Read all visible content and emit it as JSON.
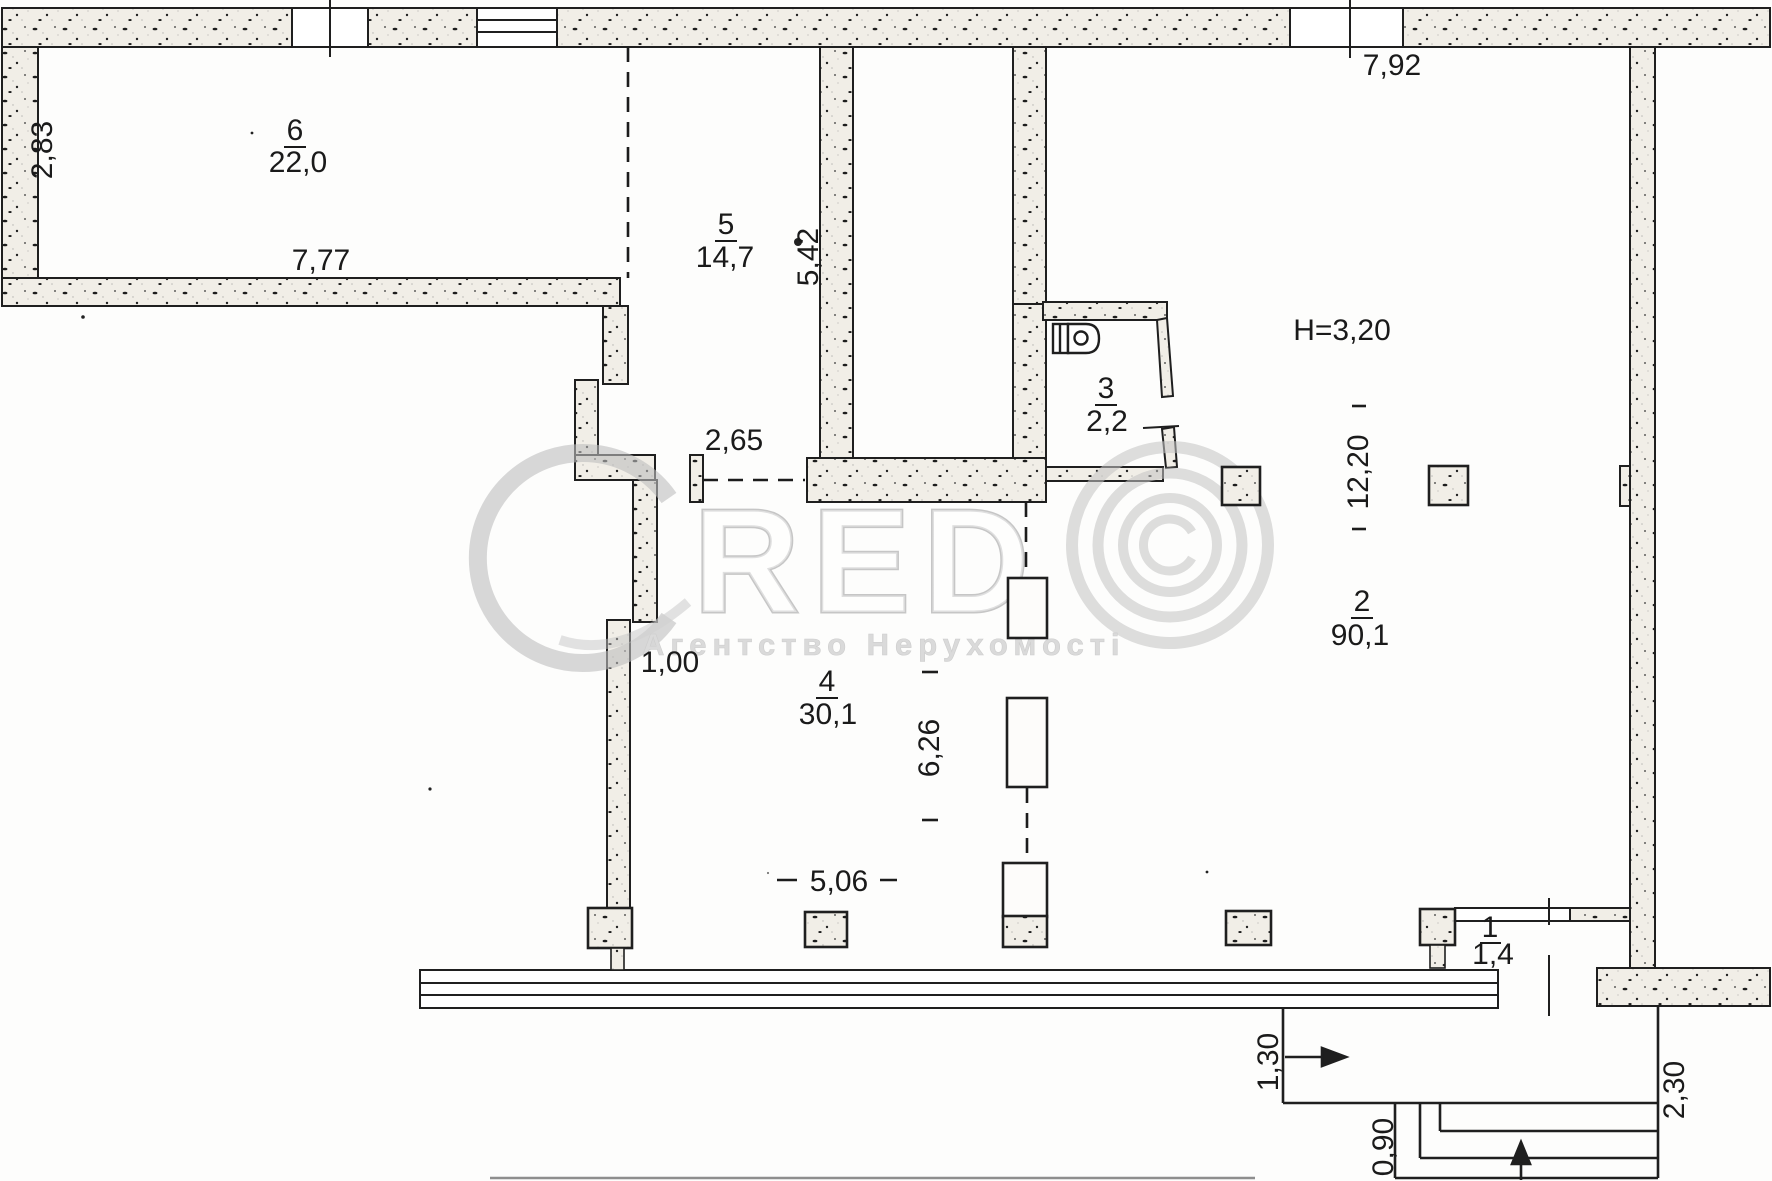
{
  "rooms": {
    "room1": {
      "number": "1",
      "area": "1,4"
    },
    "room2": {
      "number": "2",
      "area": "90,1"
    },
    "room3": {
      "number": "3",
      "area": "2,2"
    },
    "room4": {
      "number": "4",
      "area": "30,1"
    },
    "room5": {
      "number": "5",
      "area": "14,7"
    },
    "room6": {
      "number": "6",
      "area": "22,0"
    }
  },
  "dims": {
    "left_height": "2,83",
    "room6_width": "7,77",
    "top_right_width": "7,92",
    "room5_height": "5,42",
    "opening_width": "2,65",
    "niche_width": "1,00",
    "ceiling_height": "H=3,20",
    "hall_depth": "12,20",
    "hall_span": "6,26",
    "hall_width": "5,06",
    "porch_offset": "1,30",
    "step_width": "0,90",
    "porch_depth": "2,30"
  },
  "watermark": {
    "red": "RED",
    "agency": "Агентство Нерухомості"
  }
}
